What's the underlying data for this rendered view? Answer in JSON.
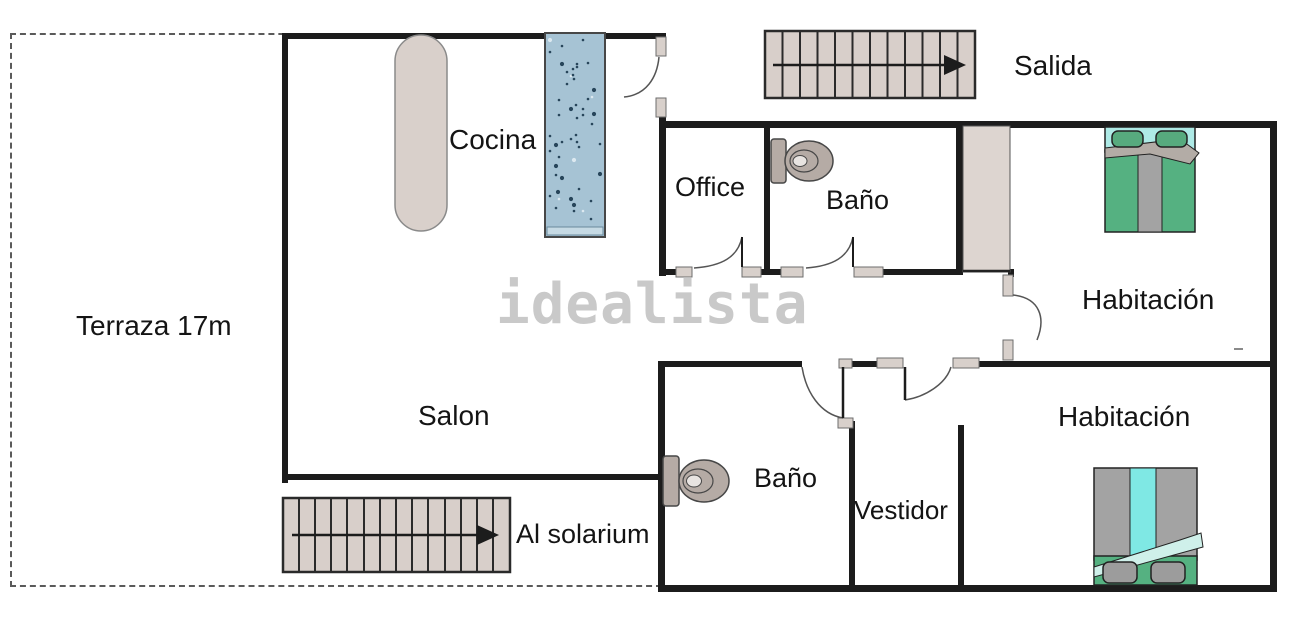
{
  "watermark": "idealista",
  "rooms": {
    "terraza": "Terraza 17m",
    "cocina": "Cocina",
    "office": "Office",
    "bano_top": "Baño",
    "habitacion_top": "Habitación",
    "salon": "Salon",
    "bano_bottom": "Baño",
    "vestidor": "Vestidor",
    "habitacion_bottom": "Habitación"
  },
  "labels": {
    "salida": "Salida",
    "al_solarium": "Al solarium"
  },
  "colors": {
    "wall": "#1c1c1c",
    "stair_fill": "#d8cfca",
    "counter_blue": "#a6c3d4",
    "furniture_beige": "#d9d0cb",
    "wardrobe_beige": "#ddd5d0",
    "toilet_gray": "#b5aba5",
    "bed_green": "#55b181",
    "bed_cyan": "#aeeae6",
    "bed_gray": "#a3a3a3",
    "watermark_gray": "#c7c7c7"
  }
}
